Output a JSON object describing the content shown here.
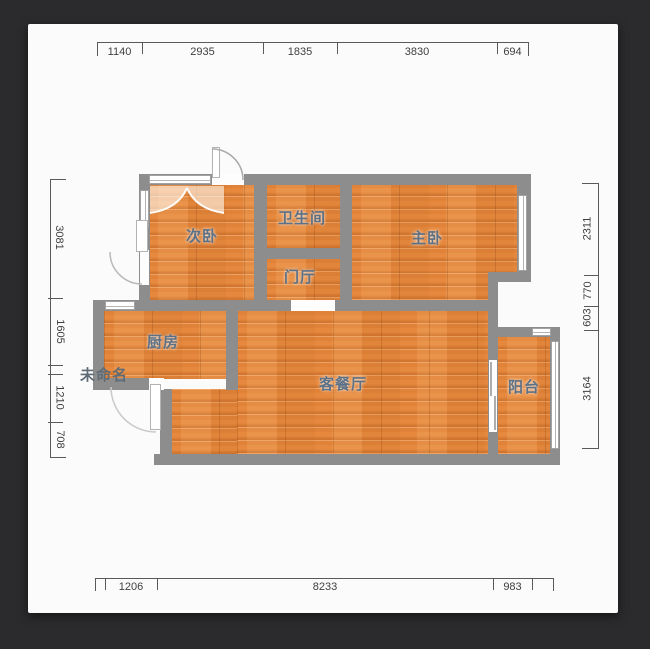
{
  "page": {
    "background": "#2b2b2d",
    "card_background": "#fbfbfb"
  },
  "colors": {
    "wall": "#8d8d8d",
    "floor_base": "#e08238",
    "room_label": "#5d7186",
    "dimension_text": "#3f3f3f"
  },
  "rooms": {
    "secondary_bedroom": "次卧",
    "bathroom": "卫生间",
    "master_bedroom": "主卧",
    "foyer": "门厅",
    "kitchen": "厨房",
    "living_dining": "客餐厅",
    "balcony": "阳台",
    "unnamed": "未命名"
  },
  "dimensions": {
    "top": [
      "1140",
      "2935",
      "1835",
      "3830",
      "694"
    ],
    "bottom": [
      "1206",
      "8233",
      "983"
    ],
    "left": [
      "3081",
      "1605",
      "1210",
      "708"
    ],
    "right": [
      "2311",
      "770",
      "603",
      "3164"
    ]
  }
}
